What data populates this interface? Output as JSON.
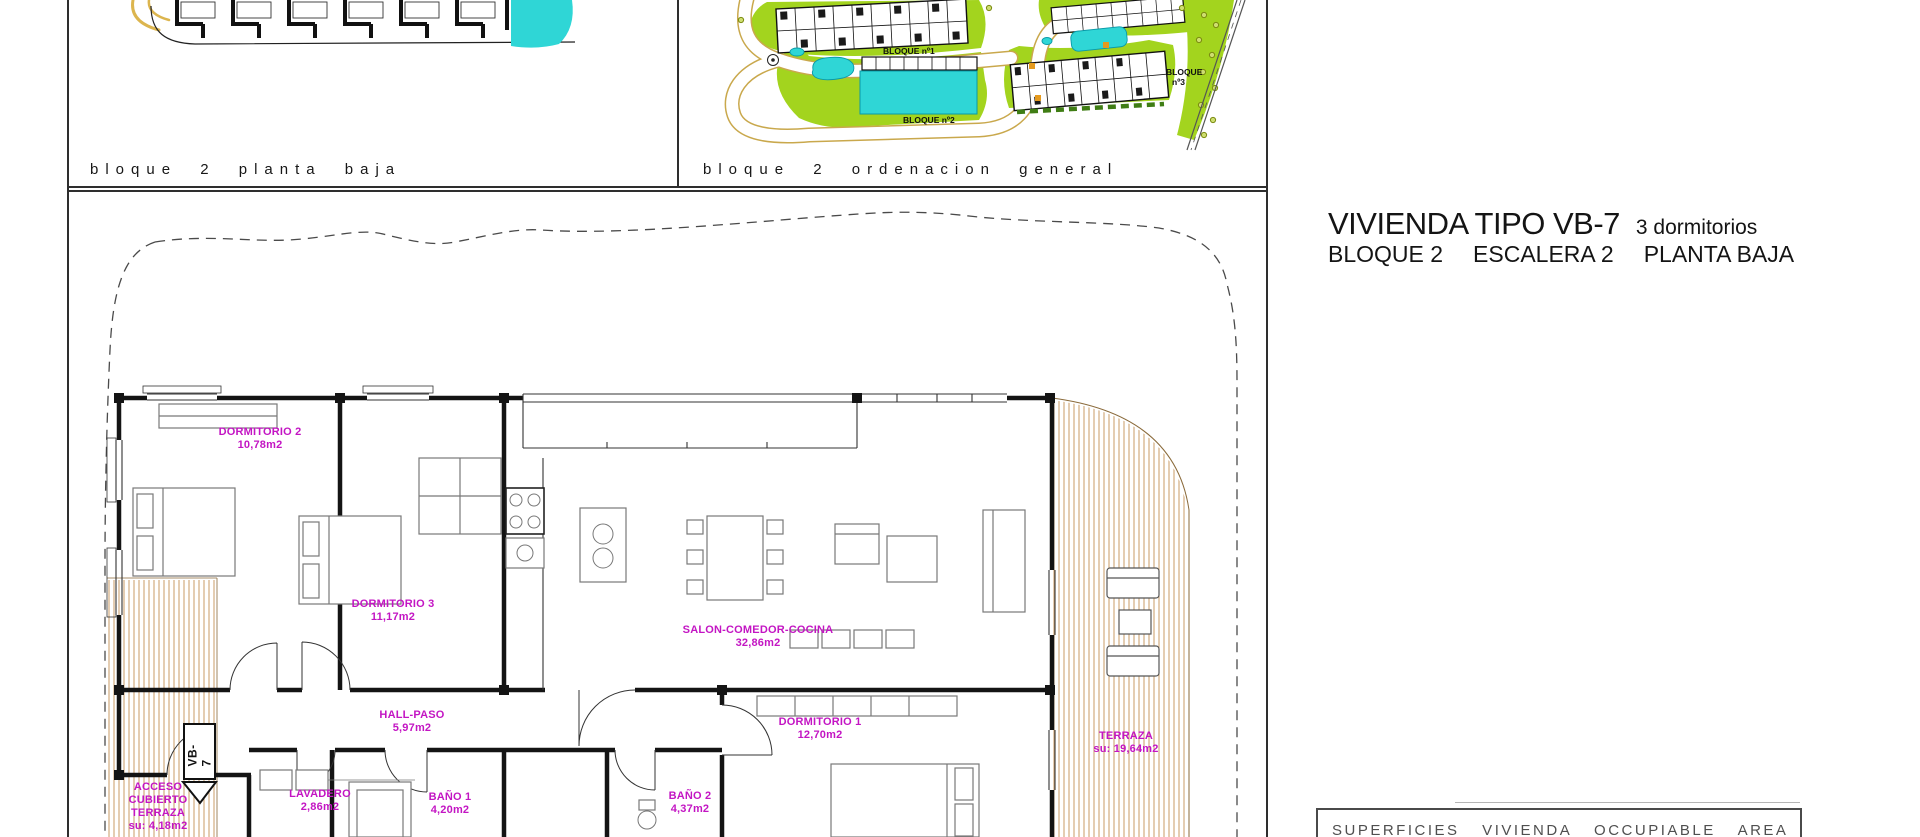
{
  "colors": {
    "highlight_cyan": "#2fd6d6",
    "label_magenta": "#c315c3",
    "hatch_tan": "#c89b66",
    "landscape_green": "#a3d41e",
    "path_yellow": "#dcb54e"
  },
  "top_left_panel": {
    "caption": "bloque 2 planta baja"
  },
  "top_middle_panel": {
    "caption": "bloque 2 ordenacion general",
    "labels": {
      "bloque1": "BLOQUE nº1",
      "bloque2": "BLOQUE nº2",
      "bloque3_line1": "BLOQUE",
      "bloque3_line2": "nº3"
    }
  },
  "title_block": {
    "main": "VIVIENDA TIPO VB-7",
    "sub": "3 dormitorios",
    "line2": [
      "BLOQUE 2",
      "ESCALERA 2",
      "PLANTA BAJA"
    ]
  },
  "floorplan": {
    "unit_tag": "VB-7",
    "rooms": {
      "dormitorio2": {
        "name": "DORMITORIO 2",
        "area": "10,78m2"
      },
      "dormitorio3": {
        "name": "DORMITORIO 3",
        "area": "11,17m2"
      },
      "salon": {
        "name": "SALON-COMEDOR-COCINA",
        "area": "32,86m2"
      },
      "hall": {
        "name": "HALL-PASO",
        "area": "5,97m2"
      },
      "dormitorio1": {
        "name": "DORMITORIO 1",
        "area": "12,70m2"
      },
      "terraza": {
        "name": "TERRAZA",
        "area": "su: 19,64m2"
      },
      "acceso": {
        "line1": "ACCESO",
        "line2": "CUBIERTO",
        "line3": "TERRAZA",
        "area": "su: 4,18m2"
      },
      "lavadero": {
        "name": "LAVADERO",
        "area": "2,86m2"
      },
      "bano1": {
        "name": "BAÑO 1",
        "area": "4,20m2"
      },
      "bano2": {
        "name": "BAÑO 2",
        "area": "4,37m2"
      }
    }
  },
  "footer": {
    "superficies": "SUPERFICIES VIVIENDA OCCUPIABLE AREA"
  }
}
